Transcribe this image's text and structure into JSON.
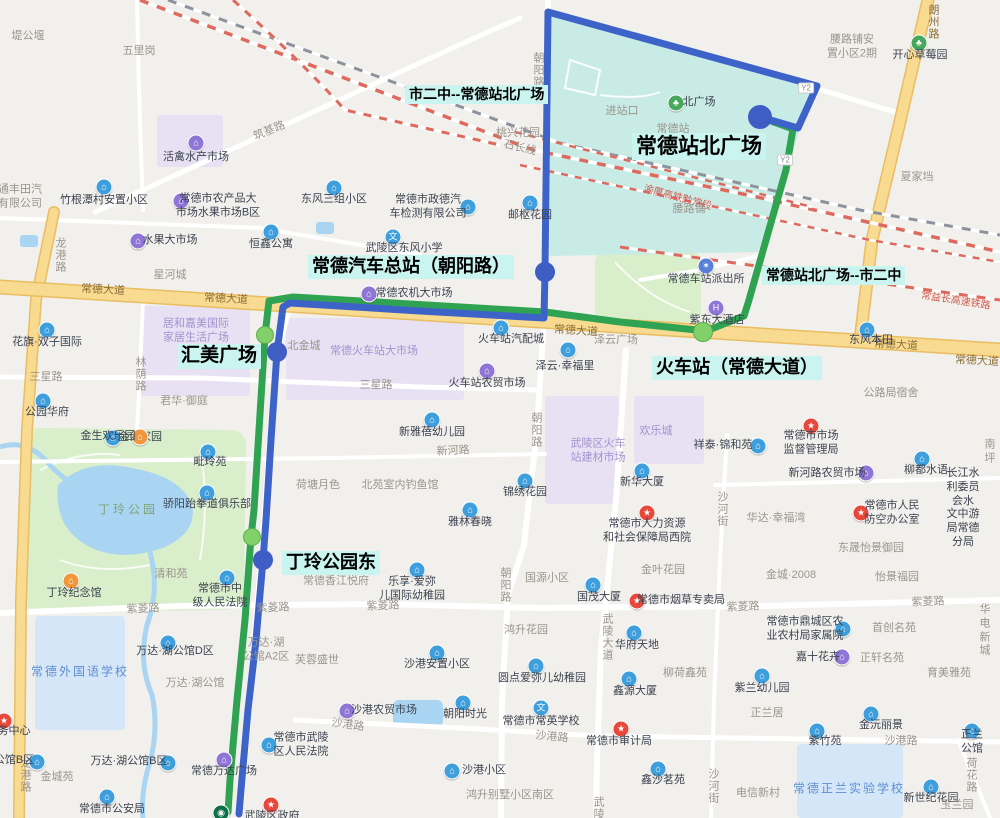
{
  "title": "常德公交线路图",
  "colors": {
    "blue_route": "#3d63c9",
    "green_route": "#2fa351",
    "blue_stop": "#3f5ec5",
    "green_stop": "#82d06a",
    "stop_label_bg": "#c9f4ef",
    "station_area": "#c9ebe6",
    "park_area": "#d9eecb",
    "water": "#a9d4f2",
    "market_area": "#e7e1f3",
    "school_area": "#d4e6f7",
    "major_road": "#f8da90",
    "railway_red": "#dd6a5e"
  },
  "routes": {
    "blue_name": "市二中--常德站北广场",
    "green_name": "常德站北广场--市二中",
    "blue_points": [
      [
        760,
        117
      ],
      [
        798,
        128
      ],
      [
        817,
        86
      ],
      [
        548,
        12
      ],
      [
        545,
        272
      ],
      [
        544,
        318
      ],
      [
        420,
        311
      ],
      [
        290,
        303
      ],
      [
        283,
        307
      ],
      [
        277,
        352
      ],
      [
        271,
        440
      ],
      [
        266,
        520
      ],
      [
        263,
        560
      ],
      [
        256,
        640
      ],
      [
        248,
        710
      ],
      [
        241,
        790
      ],
      [
        239,
        814
      ]
    ],
    "green_points": [
      [
        760,
        117
      ],
      [
        793,
        129
      ],
      [
        786,
        170
      ],
      [
        766,
        240
      ],
      [
        749,
        300
      ],
      [
        744,
        316
      ],
      [
        706,
        331
      ],
      [
        620,
        322
      ],
      [
        545,
        312
      ],
      [
        293,
        297
      ],
      [
        269,
        301
      ],
      [
        265,
        335
      ],
      [
        259,
        430
      ],
      [
        254,
        510
      ],
      [
        251,
        537
      ],
      [
        245,
        620
      ],
      [
        237,
        700
      ],
      [
        230,
        780
      ],
      [
        228,
        812
      ]
    ]
  },
  "stops": {
    "blue": [
      {
        "name": "常德站北广场",
        "x": 760,
        "y": 117,
        "r": 12
      },
      {
        "name": "常德汽车总站（朝阳路）",
        "x": 545,
        "y": 272,
        "r": 10
      },
      {
        "name": "汇美广场",
        "x": 277,
        "y": 352,
        "r": 10
      },
      {
        "name": "丁玲公园东",
        "x": 263,
        "y": 560,
        "r": 10
      }
    ],
    "green": [
      {
        "name": "火车站（常德大道）",
        "x": 703,
        "y": 332,
        "r": 10
      },
      {
        "name": "汇美广场",
        "x": 265,
        "y": 335,
        "r": 9
      },
      {
        "name": "丁玲公园东",
        "x": 252,
        "y": 537,
        "r": 9
      }
    ]
  },
  "stop_labels": [
    {
      "t": "市二中--常德站北广场",
      "x": 405,
      "y": 85,
      "fs": 14
    },
    {
      "t": "常德站北广场",
      "x": 632,
      "y": 133,
      "fs": 21
    },
    {
      "t": "常德汽车总站（朝阳路）",
      "x": 308,
      "y": 255,
      "fs": 18
    },
    {
      "t": "常德站北广场--市二中",
      "x": 762,
      "y": 266,
      "fs": 14
    },
    {
      "t": "汇美广场",
      "x": 177,
      "y": 344,
      "fs": 19
    },
    {
      "t": "火车站（常德大道）",
      "x": 652,
      "y": 356,
      "fs": 18
    },
    {
      "t": "丁玲公园东",
      "x": 282,
      "y": 551,
      "fs": 18
    }
  ],
  "road_labels": [
    {
      "t": "常德大道",
      "x": 103,
      "y": 289,
      "c": "y",
      "rot": 3
    },
    {
      "t": "常德大道",
      "x": 226,
      "y": 298,
      "c": "y",
      "rot": 3
    },
    {
      "t": "常德大道",
      "x": 576,
      "y": 330,
      "c": "y",
      "rot": 4
    },
    {
      "t": "常德大道",
      "x": 896,
      "y": 344,
      "c": "y",
      "rot": 3
    },
    {
      "t": "常德大道",
      "x": 977,
      "y": 360,
      "c": "y",
      "rot": 3
    },
    {
      "t": "朗州路",
      "x": 933,
      "y": 22,
      "v": 1,
      "c": "y"
    },
    {
      "t": "龙港路",
      "x": 60,
      "y": 255,
      "v": 1
    },
    {
      "t": "龙港路",
      "x": 25,
      "y": 775,
      "v": 1
    },
    {
      "t": "朝阳路",
      "x": 538,
      "y": 70,
      "v": 1
    },
    {
      "t": "朝阳路",
      "x": 536,
      "y": 430,
      "v": 1
    },
    {
      "t": "朝阳路",
      "x": 505,
      "y": 585,
      "v": 1
    },
    {
      "t": "武陵大道",
      "x": 607,
      "y": 637,
      "v": 1
    },
    {
      "t": "武陵",
      "x": 598,
      "y": 808,
      "v": 1
    },
    {
      "t": "紫菱路",
      "x": 143,
      "y": 608,
      "rot": -2
    },
    {
      "t": "紫菱路",
      "x": 273,
      "y": 607,
      "rot": -2
    },
    {
      "t": "紫菱路",
      "x": 383,
      "y": 605,
      "rot": -2
    },
    {
      "t": "紫菱路",
      "x": 743,
      "y": 606,
      "rot": -2
    },
    {
      "t": "紫菱路",
      "x": 928,
      "y": 601,
      "rot": -2
    },
    {
      "t": "三星路",
      "x": 46,
      "y": 376
    },
    {
      "t": "三星路",
      "x": 376,
      "y": 384
    },
    {
      "t": "新河路",
      "x": 453,
      "y": 450,
      "rot": -3
    },
    {
      "t": "沙港路",
      "x": 348,
      "y": 724,
      "rot": 8
    },
    {
      "t": "沙港路",
      "x": 552,
      "y": 736,
      "rot": 5
    },
    {
      "t": "沙港路",
      "x": 901,
      "y": 740
    },
    {
      "t": "林荫路",
      "x": 140,
      "y": 374,
      "v": 1
    },
    {
      "t": "沙河街",
      "x": 722,
      "y": 509,
      "v": 1
    },
    {
      "t": "沙河街",
      "x": 713,
      "y": 786,
      "v": 1
    },
    {
      "t": "荷花路",
      "x": 971,
      "y": 775,
      "v": 1
    },
    {
      "t": "筑基路",
      "x": 269,
      "y": 130,
      "rot": -22
    },
    {
      "t": "石长线",
      "x": 520,
      "y": 147,
      "rot": 13
    },
    {
      "t": "渝厦高铁黔常段",
      "x": 678,
      "y": 196,
      "rot": 15,
      "c": "r"
    },
    {
      "t": "常益长高速铁路",
      "x": 956,
      "y": 299,
      "rot": 9,
      "c": "r"
    },
    {
      "t": "Y2",
      "x": 806,
      "y": 88,
      "c": "badge"
    },
    {
      "t": "Y2",
      "x": 785,
      "y": 160,
      "c": "badge"
    }
  ],
  "places": [
    {
      "n": "堤公堰",
      "x": 28,
      "y": 37,
      "t": "gry"
    },
    {
      "n": "五里岗",
      "x": 139,
      "y": 52,
      "t": "gry"
    },
    {
      "n": "活禽水产市场",
      "x": 196,
      "y": 158,
      "t": "p",
      "ix": 196,
      "iy": 143
    },
    {
      "n": "通丰田汽\n有限公司",
      "x": 20,
      "y": 197,
      "t": "gry"
    },
    {
      "n": "竹根潭村安置小区",
      "x": 104,
      "y": 201,
      "t": "b",
      "ix": 104,
      "iy": 187
    },
    {
      "n": "常德市农产品大\n市场水果市场B区",
      "x": 218,
      "y": 206,
      "t": "p",
      "ix": 181,
      "iy": 201
    },
    {
      "n": "水果大市场",
      "x": 170,
      "y": 241,
      "t": "p",
      "ix": 138,
      "iy": 241
    },
    {
      "n": "恒鑫公寓",
      "x": 271,
      "y": 245,
      "t": "b",
      "ix": 271,
      "iy": 232
    },
    {
      "n": "东风三组小区",
      "x": 334,
      "y": 200,
      "t": "b",
      "ix": 334,
      "iy": 188
    },
    {
      "n": "常德市政德汽\n车检测有限公司",
      "x": 428,
      "y": 207,
      "t": "b",
      "ix": 468,
      "iy": 207
    },
    {
      "n": "邮枢花园",
      "x": 530,
      "y": 216,
      "t": "b",
      "ix": 530,
      "iy": 203
    },
    {
      "n": "桃兴花园",
      "x": 518,
      "y": 134,
      "t": "gry"
    },
    {
      "n": "武陵区东风小学",
      "x": 404,
      "y": 249,
      "t": "sc",
      "ix": 393,
      "iy": 237
    },
    {
      "n": "星河城",
      "x": 170,
      "y": 276,
      "t": "gry"
    },
    {
      "n": "常德农机大市场",
      "x": 414,
      "y": 294,
      "t": "p",
      "ix": 369,
      "iy": 294
    },
    {
      "n": "花旗·双子国际",
      "x": 47,
      "y": 343,
      "t": "b",
      "ix": 47,
      "iy": 330
    },
    {
      "n": "北金城",
      "x": 304,
      "y": 347,
      "t": "gry"
    },
    {
      "n": "居和嘉美国际\n家居生活广场",
      "x": 196,
      "y": 331,
      "t": "ptx"
    },
    {
      "n": "常德火车站大市场",
      "x": 374,
      "y": 352,
      "t": "ptx"
    },
    {
      "n": "火车站汽配城",
      "x": 511,
      "y": 340,
      "t": "b",
      "ix": 501,
      "iy": 328
    },
    {
      "n": "火车站农贸市场",
      "x": 487,
      "y": 384,
      "t": "p",
      "ix": 487,
      "iy": 371
    },
    {
      "n": "泽云广场",
      "x": 616,
      "y": 341,
      "t": "gry"
    },
    {
      "n": "泽云·幸福里",
      "x": 565,
      "y": 367,
      "t": "b",
      "ix": 568,
      "iy": 350
    },
    {
      "n": "紫东大酒店",
      "x": 717,
      "y": 321,
      "t": "h",
      "ix": 716,
      "iy": 308
    },
    {
      "n": "东风本田",
      "x": 871,
      "y": 341,
      "t": "b",
      "ix": 867,
      "iy": 330
    },
    {
      "n": "常德车站派出所",
      "x": 706,
      "y": 280,
      "t": "pl",
      "ix": 706,
      "iy": 266
    },
    {
      "n": "常德站",
      "x": 673,
      "y": 130,
      "t": "gry"
    },
    {
      "n": "进站口",
      "x": 622,
      "y": 112,
      "t": "gry"
    },
    {
      "n": "北广场",
      "x": 699,
      "y": 103,
      "t": "g",
      "ix": 676,
      "iy": 103
    },
    {
      "n": "开心草莓园",
      "x": 920,
      "y": 56,
      "t": "g",
      "ix": 919,
      "iy": 43
    },
    {
      "n": "腰路铺安\n置小区2期",
      "x": 852,
      "y": 47,
      "t": "gry"
    },
    {
      "n": "腰路铺",
      "x": 689,
      "y": 210,
      "t": "gry"
    },
    {
      "n": "夏家垱",
      "x": 917,
      "y": 178,
      "t": "gry"
    },
    {
      "n": "公路局宿舍",
      "x": 891,
      "y": 394,
      "t": "gry"
    },
    {
      "n": "君华·御庭",
      "x": 184,
      "y": 402,
      "t": "gry"
    },
    {
      "n": "公园华府",
      "x": 47,
      "y": 413,
      "t": "b",
      "ix": 43,
      "iy": 401
    },
    {
      "n": "金色家园",
      "x": 140,
      "y": 438,
      "t": "b",
      "ix": 113,
      "iy": 438
    },
    {
      "n": "金生欢乐园",
      "x": 108,
      "y": 437,
      "t": "o",
      "ix": 140,
      "iy": 437
    },
    {
      "n": "新雅蓓幼儿园",
      "x": 432,
      "y": 433,
      "t": "b",
      "ix": 432,
      "iy": 420
    },
    {
      "n": "荷塘月色",
      "x": 318,
      "y": 486,
      "t": "gry"
    },
    {
      "n": "北苑室内钓鱼馆",
      "x": 400,
      "y": 486,
      "t": "gry"
    },
    {
      "n": "锦绣花园",
      "x": 525,
      "y": 493,
      "t": "b",
      "ix": 525,
      "iy": 481
    },
    {
      "n": "雅林春晓",
      "x": 470,
      "y": 523,
      "t": "b",
      "ix": 470,
      "iy": 510
    },
    {
      "n": "新华大厦",
      "x": 642,
      "y": 483,
      "t": "b",
      "ix": 642,
      "iy": 471
    },
    {
      "n": "欢乐城",
      "x": 656,
      "y": 432,
      "t": "ptx"
    },
    {
      "n": "武陵区火车\n站建材市场",
      "x": 598,
      "y": 451,
      "t": "ptx"
    },
    {
      "n": "毗玲苑",
      "x": 210,
      "y": 463,
      "t": "b",
      "ix": 208,
      "iy": 452
    },
    {
      "n": "骄阳跆拳道俱乐部",
      "x": 207,
      "y": 505,
      "t": "b",
      "ix": 207,
      "iy": 493
    },
    {
      "n": "丁玲公园",
      "x": 128,
      "y": 510,
      "t": "pk"
    },
    {
      "n": "祥泰·锦和苑",
      "x": 723,
      "y": 446,
      "t": "b",
      "ix": 758,
      "iy": 446
    },
    {
      "n": "常德市市场\n监督管理局",
      "x": 811,
      "y": 443,
      "t": "r",
      "ix": 811,
      "iy": 426
    },
    {
      "n": "柳都水语",
      "x": 926,
      "y": 471,
      "t": "b",
      "ix": 922,
      "iy": 459
    },
    {
      "n": "南坪",
      "x": 990,
      "y": 452,
      "t": "gry"
    },
    {
      "n": "新河路农贸市场",
      "x": 827,
      "y": 474,
      "t": "p",
      "ix": 866,
      "iy": 473
    },
    {
      "n": "华达·幸福湾",
      "x": 776,
      "y": 519,
      "t": "gry"
    },
    {
      "n": "常德市人民\n防空办公室",
      "x": 892,
      "y": 513,
      "t": "r",
      "ix": 861,
      "iy": 513
    },
    {
      "n": "长江水利委员会水\n文中游局常德分局",
      "x": 963,
      "y": 508,
      "t": "txt"
    },
    {
      "n": "常德市人力资源\n和社会保障局西院",
      "x": 647,
      "y": 531,
      "t": "r",
      "ix": 647,
      "iy": 513
    },
    {
      "n": "东晟怡景御园",
      "x": 871,
      "y": 549,
      "t": "gry"
    },
    {
      "n": "金叶花园",
      "x": 663,
      "y": 571,
      "t": "gry"
    },
    {
      "n": "国源小区",
      "x": 547,
      "y": 579,
      "t": "gry"
    },
    {
      "n": "金城·2008",
      "x": 791,
      "y": 576,
      "t": "gry"
    },
    {
      "n": "怡景福园",
      "x": 897,
      "y": 578,
      "t": "gry"
    },
    {
      "n": "国茂大厦",
      "x": 599,
      "y": 598,
      "t": "b",
      "ix": 593,
      "iy": 585
    },
    {
      "n": "常德市烟草专卖局",
      "x": 681,
      "y": 601,
      "t": "r",
      "ix": 637,
      "iy": 601
    },
    {
      "n": "清和苑",
      "x": 171,
      "y": 575,
      "t": "gry"
    },
    {
      "n": "常德市中\n级人民法院",
      "x": 220,
      "y": 596,
      "t": "b",
      "ix": 227,
      "iy": 578
    },
    {
      "n": "常德香江悦府",
      "x": 336,
      "y": 582,
      "t": "gry"
    },
    {
      "n": "乐享·爱弥\n儿国际幼稚园",
      "x": 412,
      "y": 589,
      "t": "b",
      "ix": 417,
      "iy": 570
    },
    {
      "n": "丁玲纪念馆",
      "x": 74,
      "y": 594,
      "t": "o",
      "ix": 71,
      "iy": 581
    },
    {
      "n": "鸿升花园",
      "x": 526,
      "y": 631,
      "t": "gry"
    },
    {
      "n": "华府天地",
      "x": 637,
      "y": 646,
      "t": "b",
      "ix": 634,
      "iy": 633
    },
    {
      "n": "常德市鼎城区农\n业农村局家属院",
      "x": 805,
      "y": 629,
      "t": "b",
      "ix": 843,
      "iy": 629
    },
    {
      "n": "首创名苑",
      "x": 894,
      "y": 629,
      "t": "gry"
    },
    {
      "n": "华电新城",
      "x": 985,
      "y": 631,
      "t": "gry"
    },
    {
      "n": "万达·湖公馆D区",
      "x": 175,
      "y": 652,
      "t": "b",
      "ix": 168,
      "iy": 643
    },
    {
      "n": "万达·湖\n公馆A2区",
      "x": 266,
      "y": 650,
      "t": "gry"
    },
    {
      "n": "芙蓉盛世",
      "x": 317,
      "y": 661,
      "t": "gry"
    },
    {
      "n": "沙港安置小区",
      "x": 437,
      "y": 665,
      "t": "b",
      "ix": 437,
      "iy": 653
    },
    {
      "n": "嘉十花卉",
      "x": 818,
      "y": 658,
      "t": "p",
      "ix": 842,
      "iy": 657
    },
    {
      "n": "正轩名苑",
      "x": 882,
      "y": 659,
      "t": "gry"
    },
    {
      "n": "育美雅苑",
      "x": 949,
      "y": 674,
      "t": "gry"
    },
    {
      "n": "柳荷鑫苑",
      "x": 685,
      "y": 674,
      "t": "gry"
    },
    {
      "n": "万达·湖公馆",
      "x": 195,
      "y": 684,
      "t": "gry"
    },
    {
      "n": "紫兰幼儿园",
      "x": 762,
      "y": 689,
      "t": "b",
      "ix": 762,
      "iy": 676
    },
    {
      "n": "鑫源大厦",
      "x": 635,
      "y": 692,
      "t": "b",
      "ix": 629,
      "iy": 679
    },
    {
      "n": "沙港农贸市场",
      "x": 384,
      "y": 711,
      "t": "p",
      "ix": 347,
      "iy": 711
    },
    {
      "n": "正兰居",
      "x": 767,
      "y": 714,
      "t": "gry"
    },
    {
      "n": "朝阳时光",
      "x": 465,
      "y": 715,
      "t": "b",
      "ix": 463,
      "iy": 703
    },
    {
      "n": "常德市常英学校",
      "x": 541,
      "y": 722,
      "t": "sc",
      "ix": 541,
      "iy": 708
    },
    {
      "n": "圆点爱弥儿幼稚园",
      "x": 542,
      "y": 679,
      "t": "b",
      "ix": 536,
      "iy": 666
    },
    {
      "n": "金沅丽景",
      "x": 881,
      "y": 726,
      "t": "b",
      "ix": 871,
      "iy": 714
    },
    {
      "n": "紫竹苑",
      "x": 825,
      "y": 742,
      "t": "b",
      "ix": 817,
      "iy": 731
    },
    {
      "n": "正兰公馆",
      "x": 972,
      "y": 742,
      "t": "b",
      "ix": 972,
      "iy": 731
    },
    {
      "n": "常德市武陵\n区人民法院",
      "x": 301,
      "y": 745,
      "t": "b",
      "ix": 269,
      "iy": 745
    },
    {
      "n": "常德市审计局",
      "x": 619,
      "y": 742,
      "t": "r",
      "ix": 621,
      "iy": 729
    },
    {
      "n": "沙港小区",
      "x": 484,
      "y": 771,
      "t": "b",
      "ix": 452,
      "iy": 771
    },
    {
      "n": "常德万达广场",
      "x": 224,
      "y": 772,
      "t": "p",
      "ix": 224,
      "iy": 760
    },
    {
      "n": "万达·湖公馆B区",
      "x": 129,
      "y": 762,
      "t": "b",
      "ix": 168,
      "iy": 763
    },
    {
      "n": "公馆B区",
      "x": 14,
      "y": 761,
      "t": "b",
      "ix": 37,
      "iy": 762
    },
    {
      "n": "金城苑",
      "x": 57,
      "y": 778,
      "t": "gry"
    },
    {
      "n": "鑫沙茗苑",
      "x": 663,
      "y": 781,
      "t": "b",
      "ix": 658,
      "iy": 769
    },
    {
      "n": "电信新村",
      "x": 758,
      "y": 794,
      "t": "gry"
    },
    {
      "n": "常德正兰实验学校",
      "x": 849,
      "y": 789,
      "t": "wt"
    },
    {
      "n": "新世纪花园",
      "x": 931,
      "y": 799,
      "t": "b",
      "ix": 931,
      "iy": 787
    },
    {
      "n": "玉兰园",
      "x": 957,
      "y": 806,
      "t": "gry"
    },
    {
      "n": "鸿升别墅小区南区",
      "x": 510,
      "y": 796,
      "t": "gry"
    },
    {
      "n": "常德市公安局",
      "x": 112,
      "y": 810,
      "t": "b",
      "ix": 107,
      "iy": 797
    },
    {
      "n": "常德外国语学校",
      "x": 80,
      "y": 672,
      "t": "wt"
    },
    {
      "n": "务中心",
      "x": 14,
      "y": 732,
      "t": "r",
      "ix": 4,
      "iy": 721
    },
    {
      "n": "武陵区政府",
      "x": 272,
      "y": 817,
      "t": "r",
      "ix": 271,
      "iy": 805
    },
    {
      "n": "",
      "x": 0,
      "y": 0,
      "t": "sb",
      "ix": 221,
      "iy": 813
    }
  ]
}
